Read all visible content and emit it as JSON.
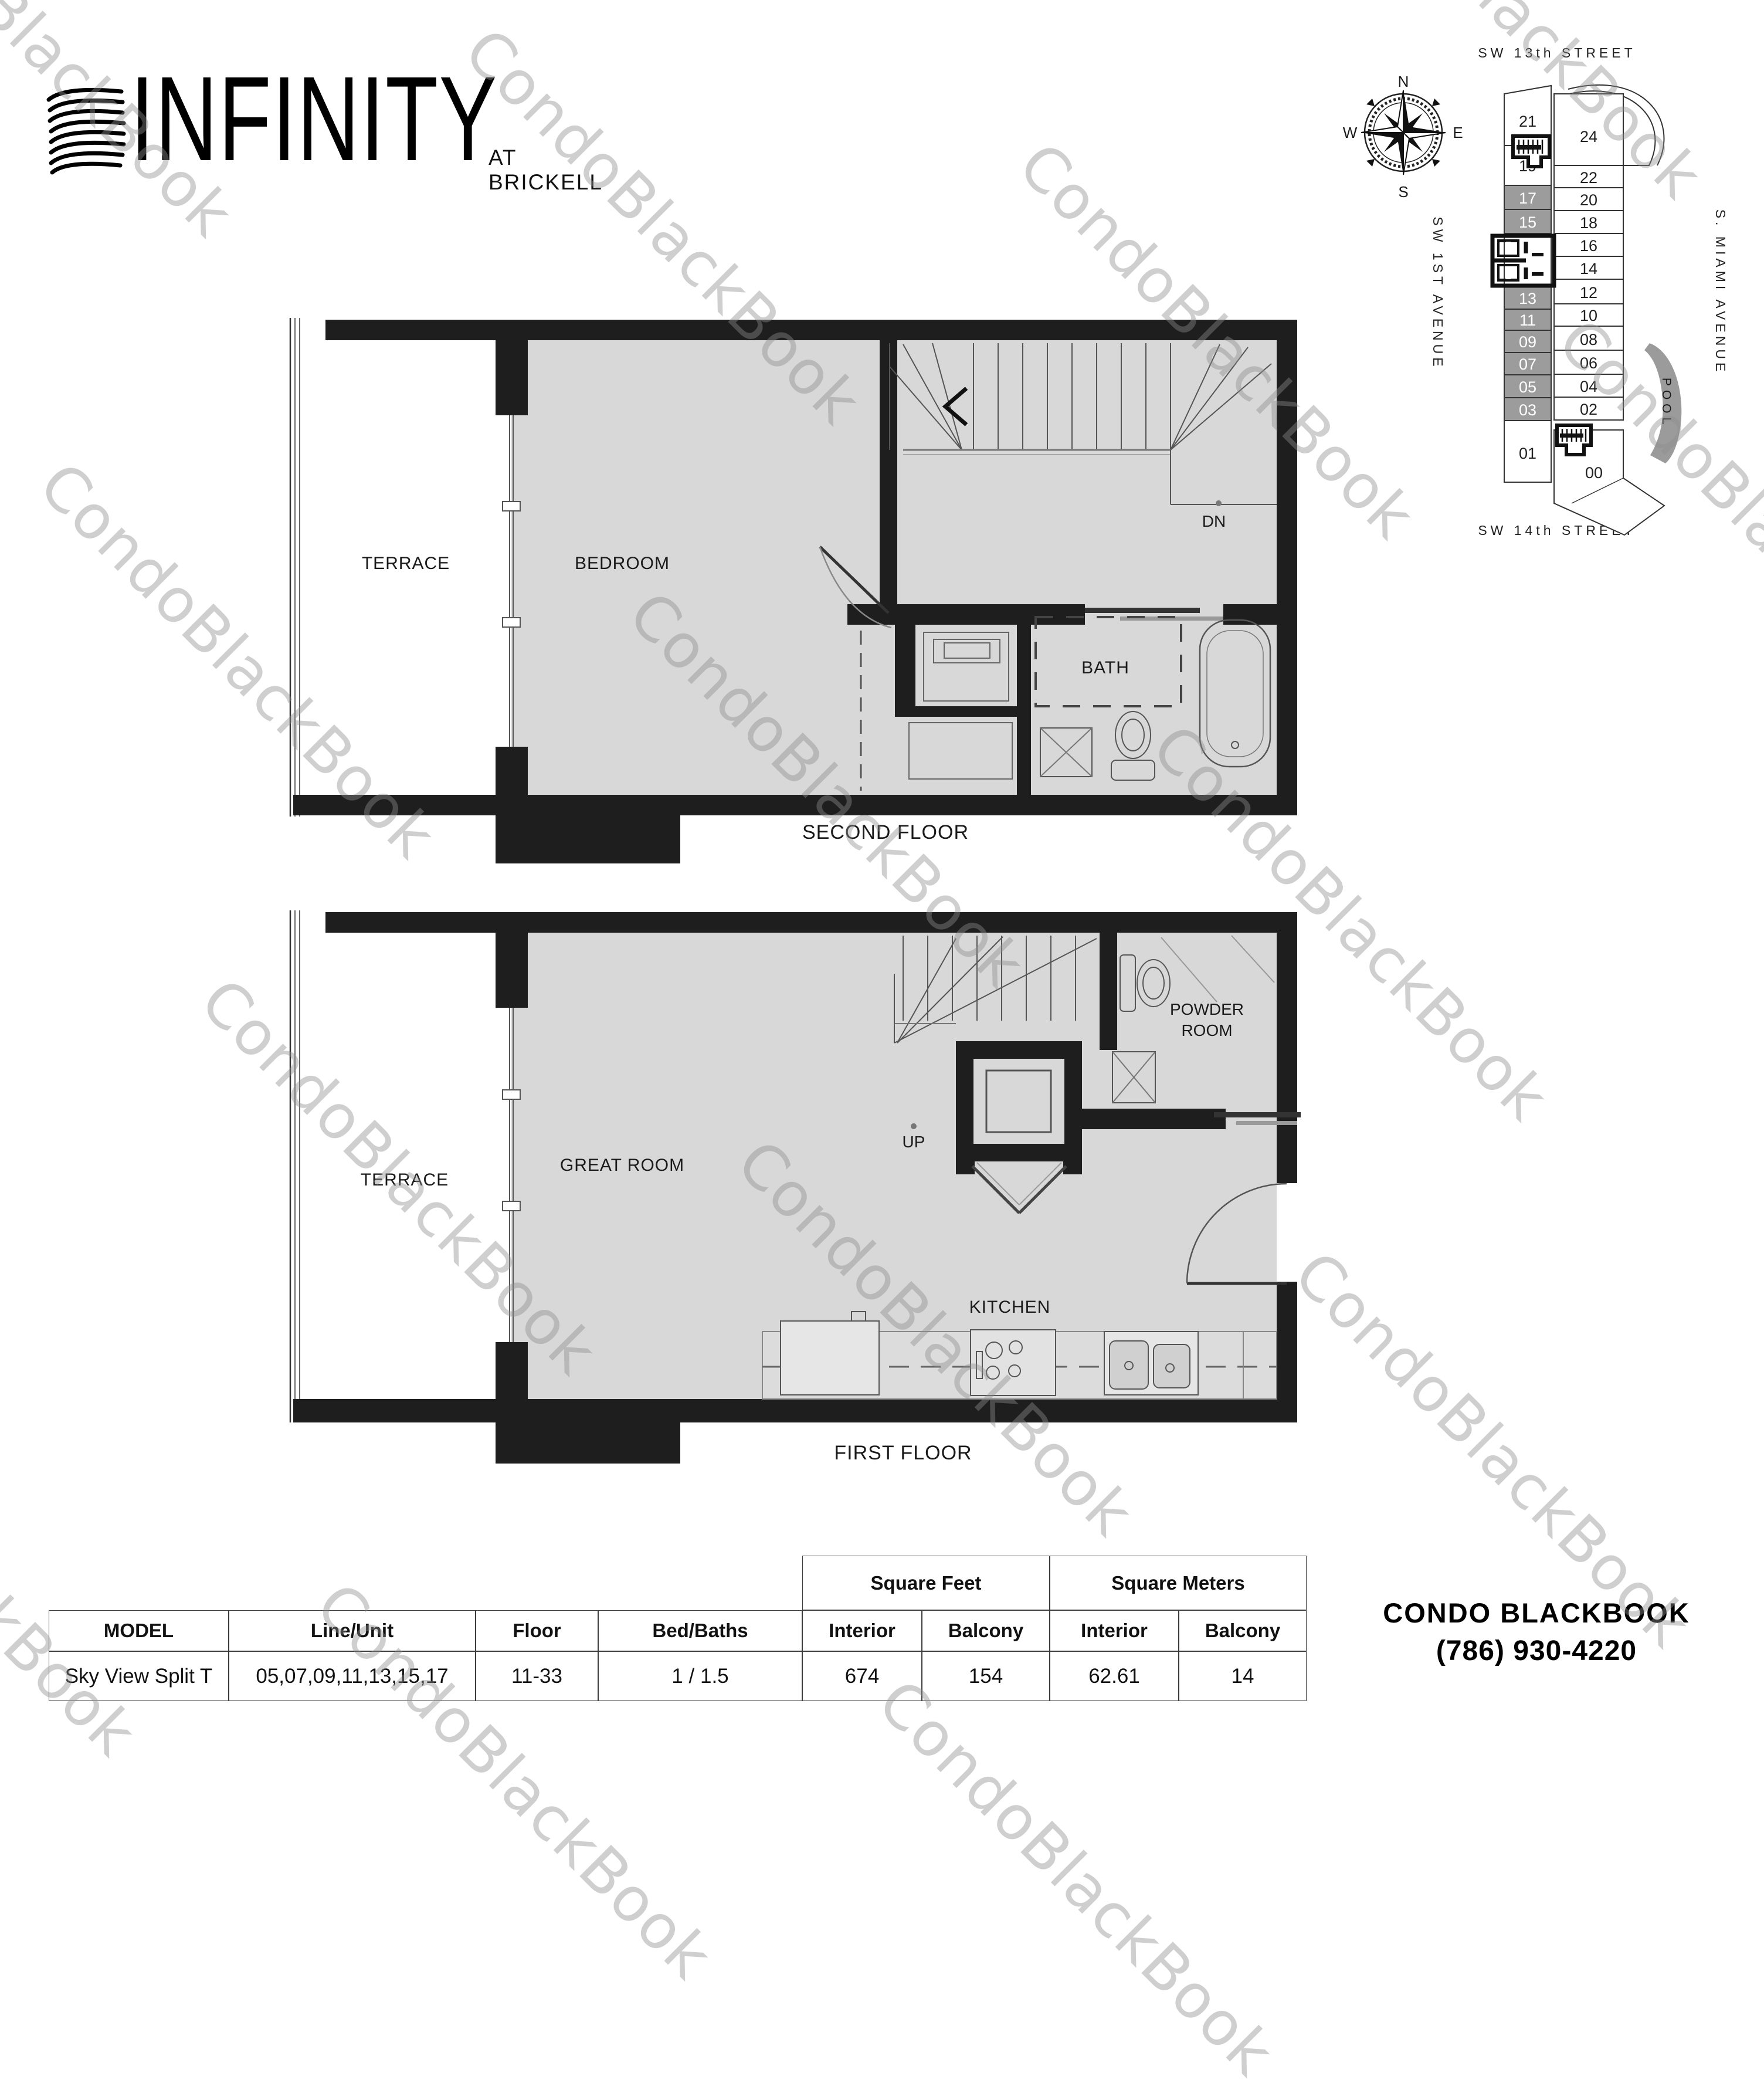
{
  "logo": {
    "name": "INFINITY",
    "tagline": "AT BRICKELL"
  },
  "watermark": {
    "text": "CondoBlackBook"
  },
  "site_plan": {
    "street_top": "SW 13th STREET",
    "street_bottom": "SW 14th STREET",
    "avenue_left": "SW 1ST AVENUE",
    "avenue_right": "S. MIAMI AVENUE",
    "pool": "POOL",
    "compass": {
      "n": "N",
      "e": "E",
      "s": "S",
      "w": "W"
    },
    "west_units": [
      "21",
      "19",
      "17",
      "15",
      "13",
      "11",
      "09",
      "07",
      "05",
      "03",
      "01"
    ],
    "east_units": [
      "24",
      "22",
      "20",
      "18",
      "16",
      "14",
      "12",
      "10",
      "08",
      "06",
      "04",
      "02",
      "00"
    ],
    "highlighted_units": [
      "17",
      "15",
      "13",
      "11",
      "09",
      "07",
      "05",
      "03"
    ],
    "highlight_color": "#9c9c9c"
  },
  "second_floor": {
    "caption": "SECOND FLOOR",
    "terrace": "TERRACE",
    "bedroom": "BEDROOM",
    "bath": "BATH",
    "down": "DN"
  },
  "first_floor": {
    "caption": "FIRST FLOOR",
    "terrace": "TERRACE",
    "great_room": "GREAT ROOM",
    "up": "UP",
    "powder_line1": "POWDER",
    "powder_line2": "ROOM",
    "kitchen": "KITCHEN"
  },
  "spec_table": {
    "group_headers": [
      "Square Feet",
      "Square Meters"
    ],
    "columns": [
      "MODEL",
      "Line/Unit",
      "Floor",
      "Bed/Baths",
      "Interior",
      "Balcony",
      "Interior",
      "Balcony"
    ],
    "row": {
      "model": "Sky View Split T",
      "line_unit": "05,07,09,11,13,15,17",
      "floor": "11-33",
      "bed_baths": "1 / 1.5",
      "sf_interior": "674",
      "sf_balcony": "154",
      "sm_interior": "62.61",
      "sm_balcony": "14"
    }
  },
  "contact": {
    "brand": "CONDO BLACKBOOK",
    "phone": "(786) 930-4220"
  },
  "colors": {
    "wall": "#1e1e1e",
    "floor_fill": "#d8d8d8",
    "highlight": "#9c9c9c",
    "watermark": "#c7c7c7"
  }
}
